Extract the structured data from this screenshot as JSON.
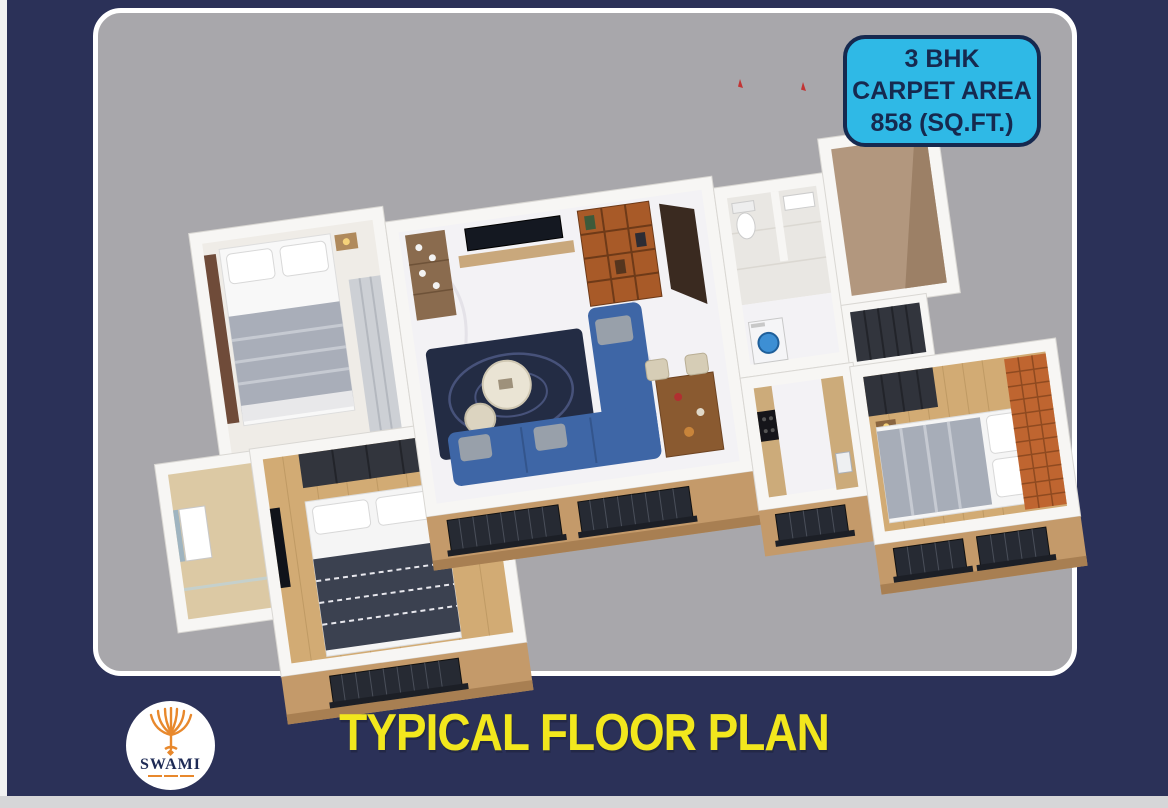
{
  "page": {
    "background_color": "#2b3158",
    "left_strip_color": "#f2f2f2",
    "bottom_strip_color": "#d6d6d8"
  },
  "card": {
    "background_color": "#a8a7ab",
    "border_color": "#ffffff"
  },
  "badge": {
    "line1": "3 BHK",
    "line2": "CARPET AREA",
    "line3": "858 (SQ.FT.)",
    "background_color": "#2fb9e6",
    "text_color": "#16294f",
    "border_color": "#16294f"
  },
  "footer": {
    "title": "TYPICAL FLOOR PLAN",
    "title_color": "#f2e71d"
  },
  "logo": {
    "name": "SWAMI",
    "name_color": "#1d2a55",
    "emblem_color": "#e8882c",
    "circle_color": "#ffffff"
  },
  "floor_plan": {
    "wall_color": "#f7f6f4",
    "wall_face_color": "#c49a6a",
    "marble_floor_color": "#f3f2f5",
    "wood_floor_color": "#d2ab74",
    "bath_floor_color": "#e9e7e3",
    "rug_color": "#232c44",
    "sofa_color": "#3e66a6",
    "accent_wall_color": "#bf6530",
    "bookshelf_color": "#a85a28",
    "window_color": "#262a33",
    "wardrobe_dark_color": "#32353d",
    "duvet_gray_color": "#a9aeb9",
    "duvet_dark_color": "#3b4150"
  }
}
